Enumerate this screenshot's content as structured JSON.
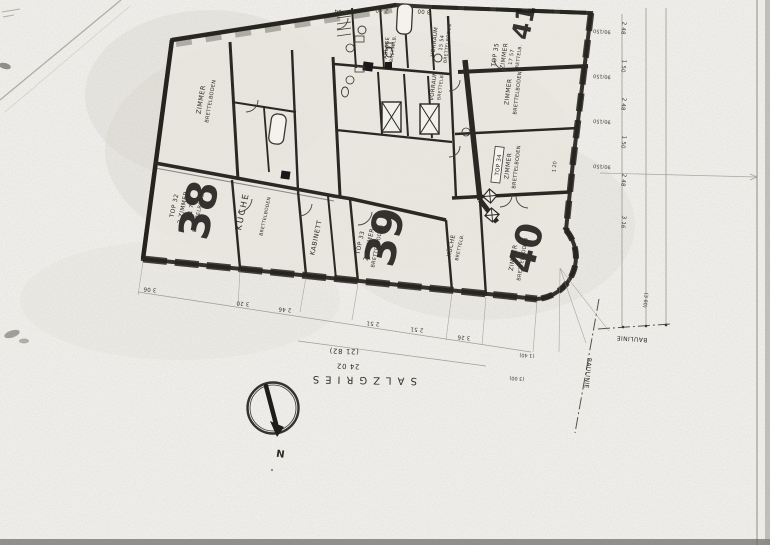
{
  "sheet": {
    "north_label": "N",
    "street": {
      "name": "SALZGRIES",
      "dim_inner": "(21 82)",
      "dim_outer": "24 02"
    },
    "baulinie_a": "BAULINIE",
    "baulinie_b": "BAULINIE"
  },
  "apartments": {
    "a38": {
      "number": "38",
      "top_no": "TOP 32",
      "room": "2 ZIMMER",
      "area": "21 70",
      "floor": "BRETTELBODEN"
    },
    "a39": {
      "number": "39",
      "top_no": "TOP 33",
      "room": "2 ZIMMER",
      "floor": "BRETTELBODEN"
    },
    "a40": {
      "number": "40",
      "top_no": "TOP 34",
      "room": "ZIMMER",
      "floor": "BRETTELBODEN"
    },
    "a41": {
      "number": "41",
      "top_no": "TOP 35",
      "room": "ZIMMER",
      "area": "17 57",
      "floor": "BRETTELB."
    }
  },
  "rooms": {
    "zimmer_nw": {
      "name": "ZIMMER",
      "floor": "BRETTELBODEN"
    },
    "kueche_a": {
      "name": "KÜCHE",
      "floor": "BRETTELBODEN"
    },
    "kabinett": {
      "name": "KABINETT"
    },
    "kueche_b": {
      "name": "KÜCHE",
      "floor": "BRETTELB."
    },
    "vorraum_a": {
      "name": "VORRAUM",
      "area": "15 54",
      "floor": "BRETTELBODEN"
    },
    "vorraum_b": {
      "name": "VORRAUM",
      "floor": "BRETTELB."
    },
    "zimmer_r1": {
      "name": "ZIMMER",
      "floor": "BRETTELBODEN"
    },
    "ablage": {
      "name": "ABLAGE",
      "floor": "BRETTELB."
    }
  },
  "dimensions": {
    "top": [
      "4 04",
      "2 40",
      "3 00"
    ],
    "bottom": [
      "3 06",
      "3 20",
      "2 46",
      "2 51",
      "2 51",
      "3 26"
    ],
    "right_windows": [
      "90/150",
      "90/150",
      "90/150",
      "90/150"
    ],
    "right_chain": [
      "2 48",
      "1 50",
      "2 48",
      "1 50",
      "2 48",
      "3 16"
    ],
    "corner": [
      "(1 40)",
      "(3 00)",
      "(3 60)",
      "1 20"
    ]
  }
}
